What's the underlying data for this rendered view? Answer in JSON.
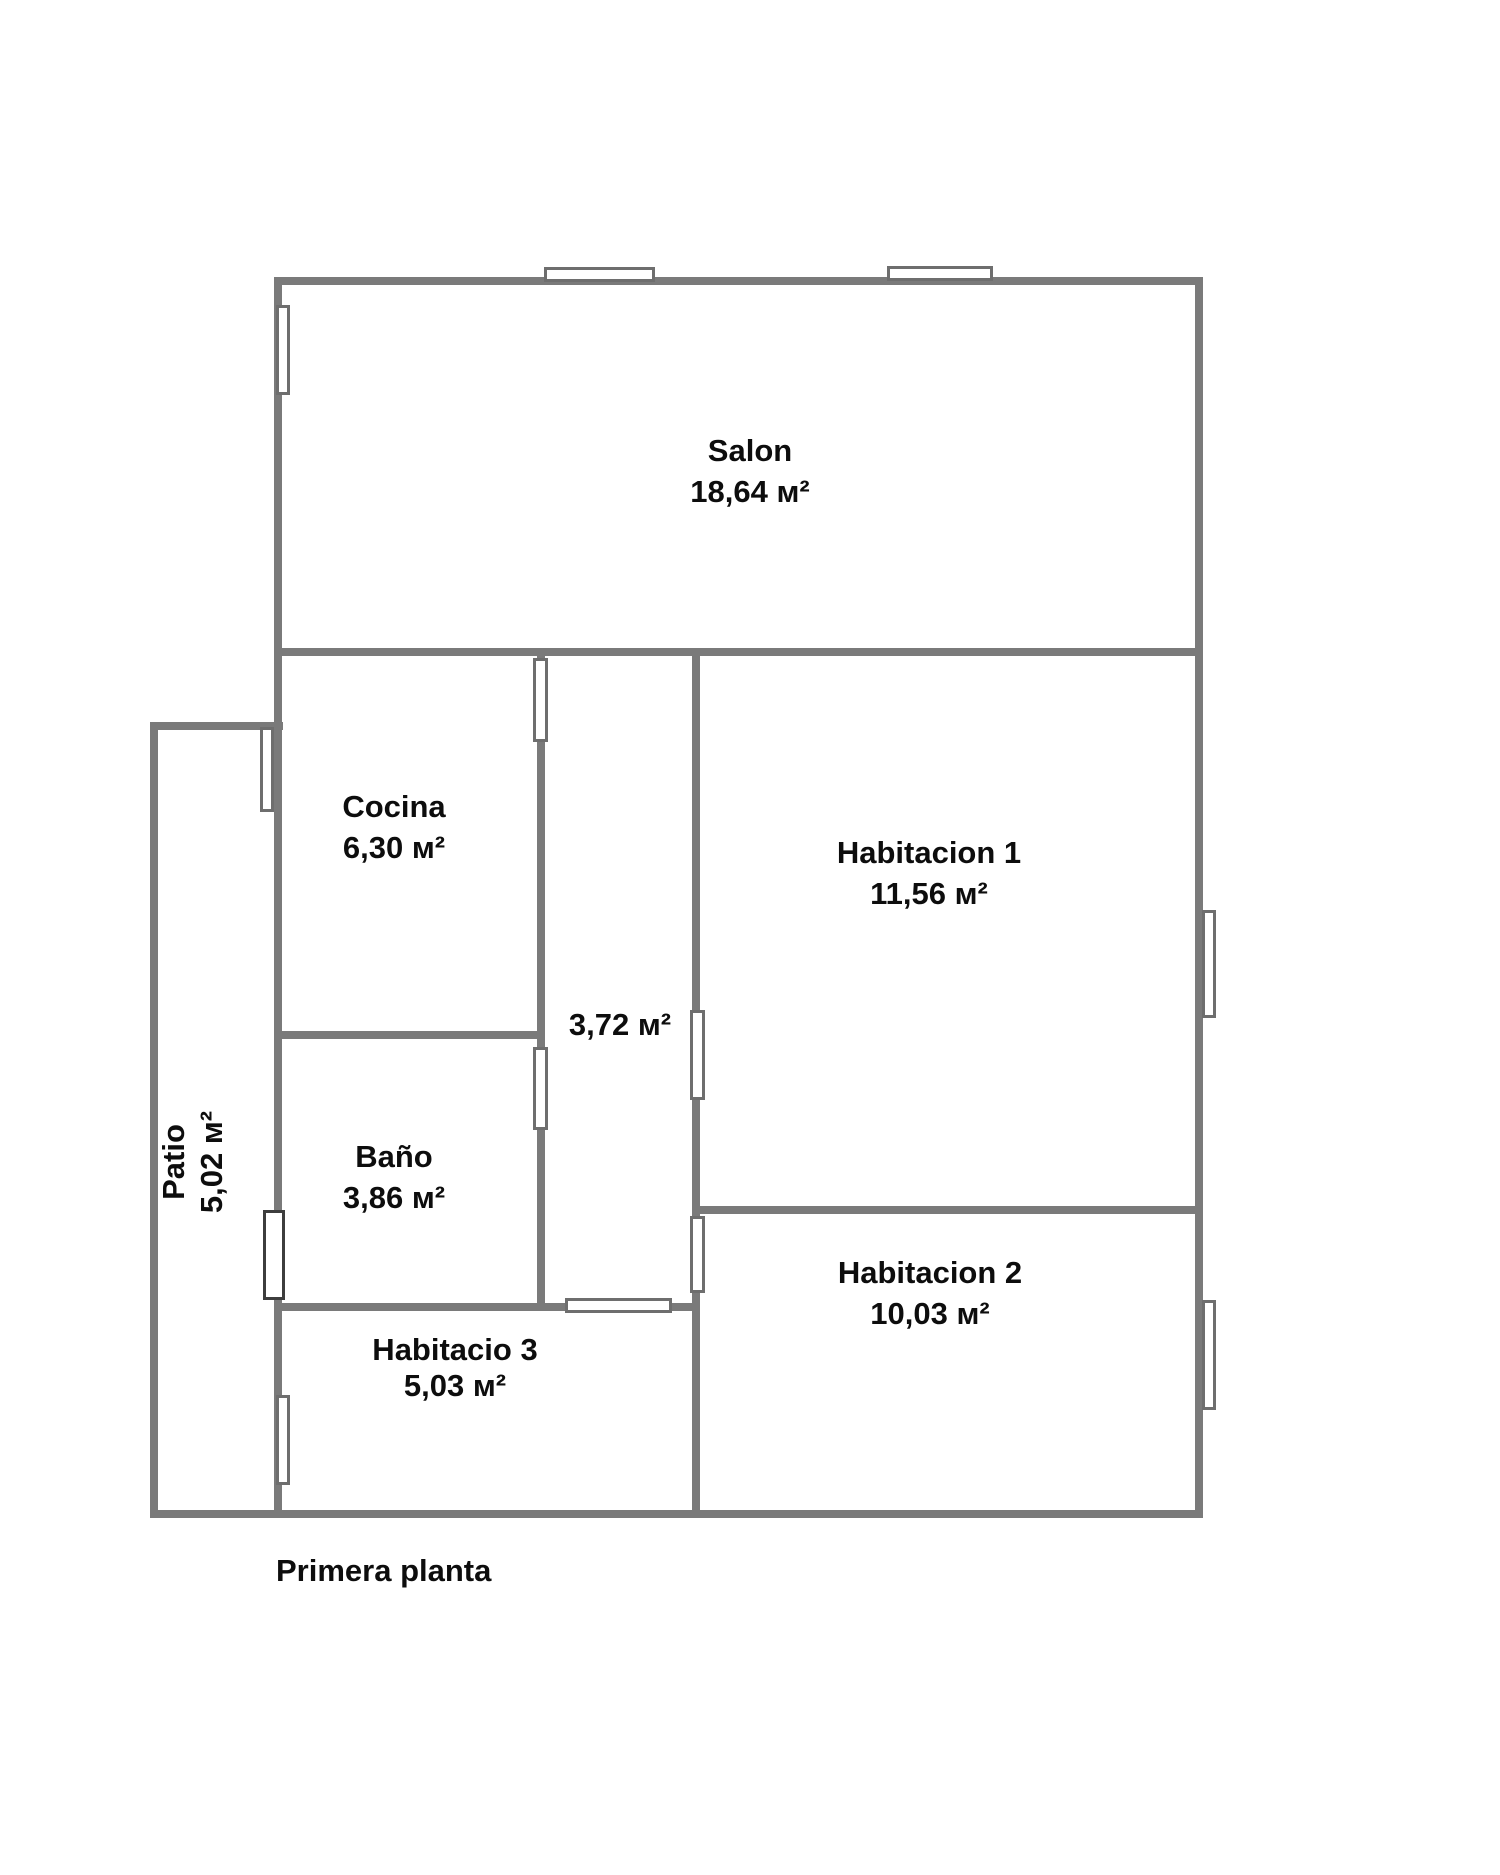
{
  "title": "Primera planta",
  "rooms": {
    "salon": {
      "name": "Salon",
      "area": "18,64 м²"
    },
    "cocina": {
      "name": "Cocina",
      "area": "6,30 м²"
    },
    "habitacion1": {
      "name": "Habitacion 1",
      "area": "11,56 м²"
    },
    "pasillo": {
      "area": "3,72 м²"
    },
    "bano": {
      "name": "Baño",
      "area": "3,86 м²"
    },
    "habitacion2": {
      "name": "Habitacion 2",
      "area": "10,03 м²"
    },
    "habitacio3": {
      "name": "Habitacio 3",
      "area": "5,03 м²"
    },
    "patio": {
      "name": "Patio",
      "area": "5,02 м²"
    }
  },
  "colors": {
    "wall": "#7a7a7a",
    "opening_border": "#6e6e6e",
    "door_border": "#3d3d3d",
    "text": "#0d0d0d",
    "background": "#ffffff"
  }
}
